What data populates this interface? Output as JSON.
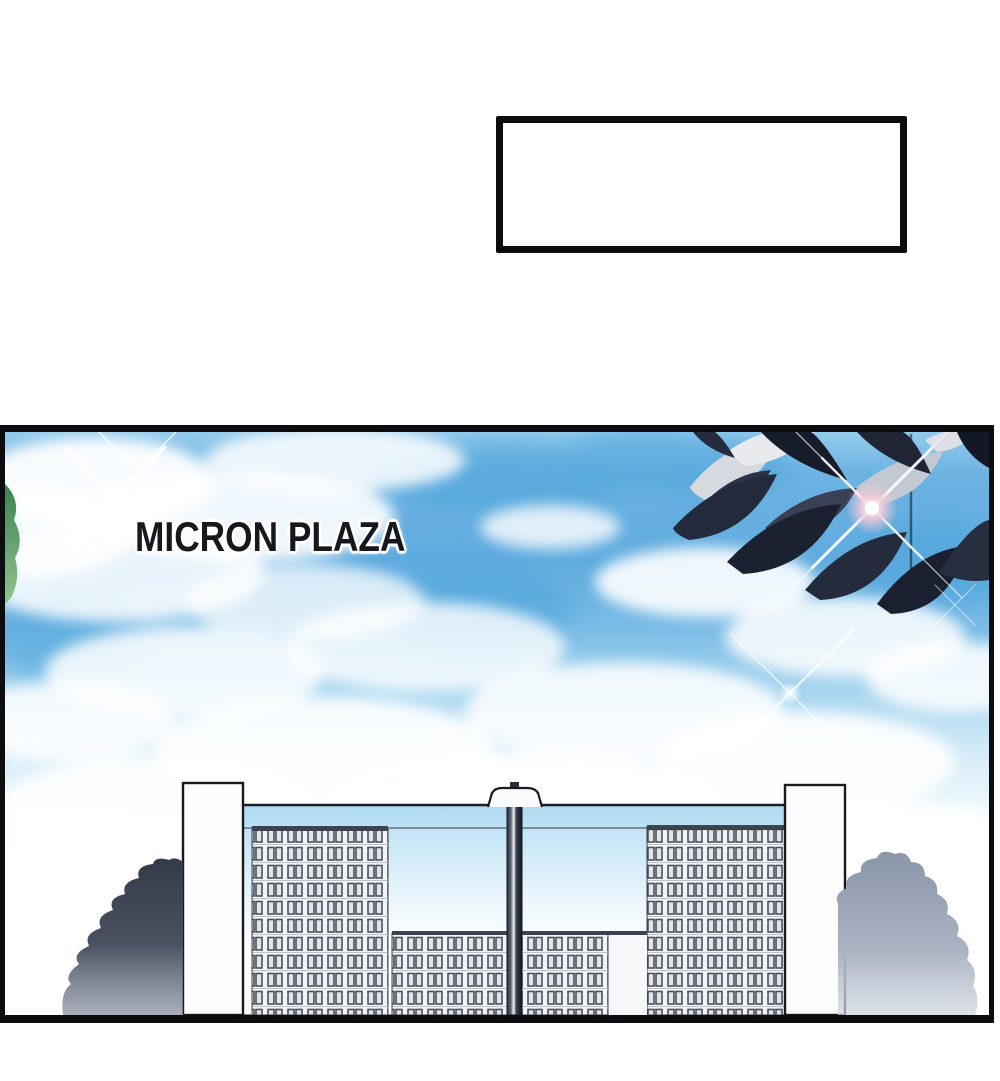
{
  "speech_box": {
    "text": ""
  },
  "panel": {
    "title": "MICRON PLAZA",
    "colors": {
      "border": "#0d0d0f",
      "title_text": "#17181c",
      "sky_deep": "#5fabdf",
      "sky_pale": "#eaf6fc",
      "leaf_dark": "#1e2433",
      "leaf_light": "#d6dae0",
      "window_frame": "#4b515c",
      "tree_left": "#3c4250",
      "tree_right": "#97a2b4",
      "lens_flare_pink": "#f3c9d8"
    }
  }
}
